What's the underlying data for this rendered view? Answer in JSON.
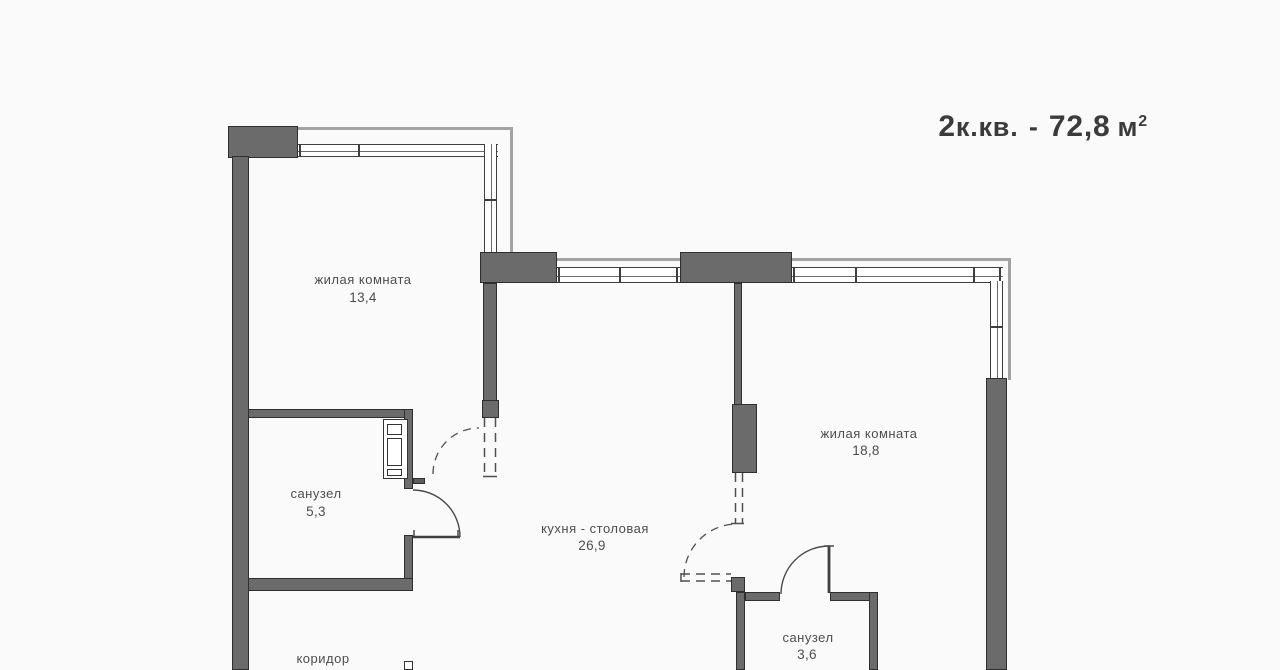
{
  "title": {
    "number": "2",
    "type": "к.кв.",
    "separator": " - ",
    "area": "72,8",
    "unit": "м",
    "superscript": "2"
  },
  "rooms": {
    "living1": {
      "name": "жилая комната",
      "area": "13,4"
    },
    "bathroom1": {
      "name": "санузел",
      "area": "5,3"
    },
    "kitchen": {
      "name": "кухня - столовая",
      "area": "26,9"
    },
    "living2": {
      "name": "жилая комната",
      "area": "18,8"
    },
    "bathroom2": {
      "name": "санузел",
      "area": "3,6"
    },
    "corridor": {
      "name": "коридор"
    }
  },
  "colors": {
    "wall_fill": "#6b6b6b",
    "wall_border": "#2f2f2f",
    "background": "#fafafa",
    "window_line": "#3f3f3f",
    "facade_line": "#a3a3a3",
    "text": "#4d4d4d",
    "title_text": "#3b3b3b"
  }
}
